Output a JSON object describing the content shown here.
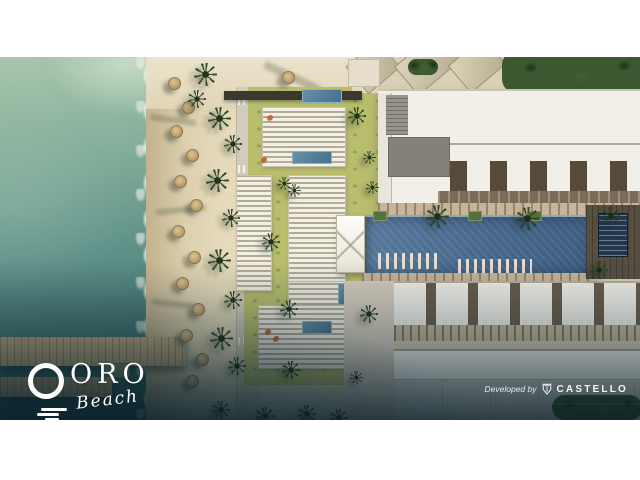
{
  "branding": {
    "title": "ORO",
    "subtitle": "Beach",
    "icon": "sun-over-waves-icon"
  },
  "credits": {
    "prefix": "Developed by",
    "name": "CASTELLO",
    "icon": "castello-crest-icon"
  },
  "scene": {
    "type": "aerial-architectural-rendering",
    "description": "Top-down aerial render of the ORO Beach resort: turquoise sea with two wooden piers on the left, a sandy beach lined with palms and straw umbrellas, beach-club lawns, pergola sunbed decks and plunge pools in the centre, and two long white residential blocks flanking a large blue lap pool with a white sail canopy on the right.",
    "colors": {
      "sea_light": "#a9c6ac",
      "sea_deep": "#2e5a5e",
      "foam": "#f2efe2",
      "sand": "#e3d7b8",
      "lawn": "#b9be6e",
      "deck": "#d9d0b7",
      "pool": "#47688e",
      "building_white": "#f2efe8",
      "roof_gray": "#84817a",
      "pier": "#c9ae83",
      "palm_green": "#33502b",
      "umbrella_tan": "#b39767",
      "vignette": "#0a222c",
      "text": "#ffffff"
    }
  }
}
